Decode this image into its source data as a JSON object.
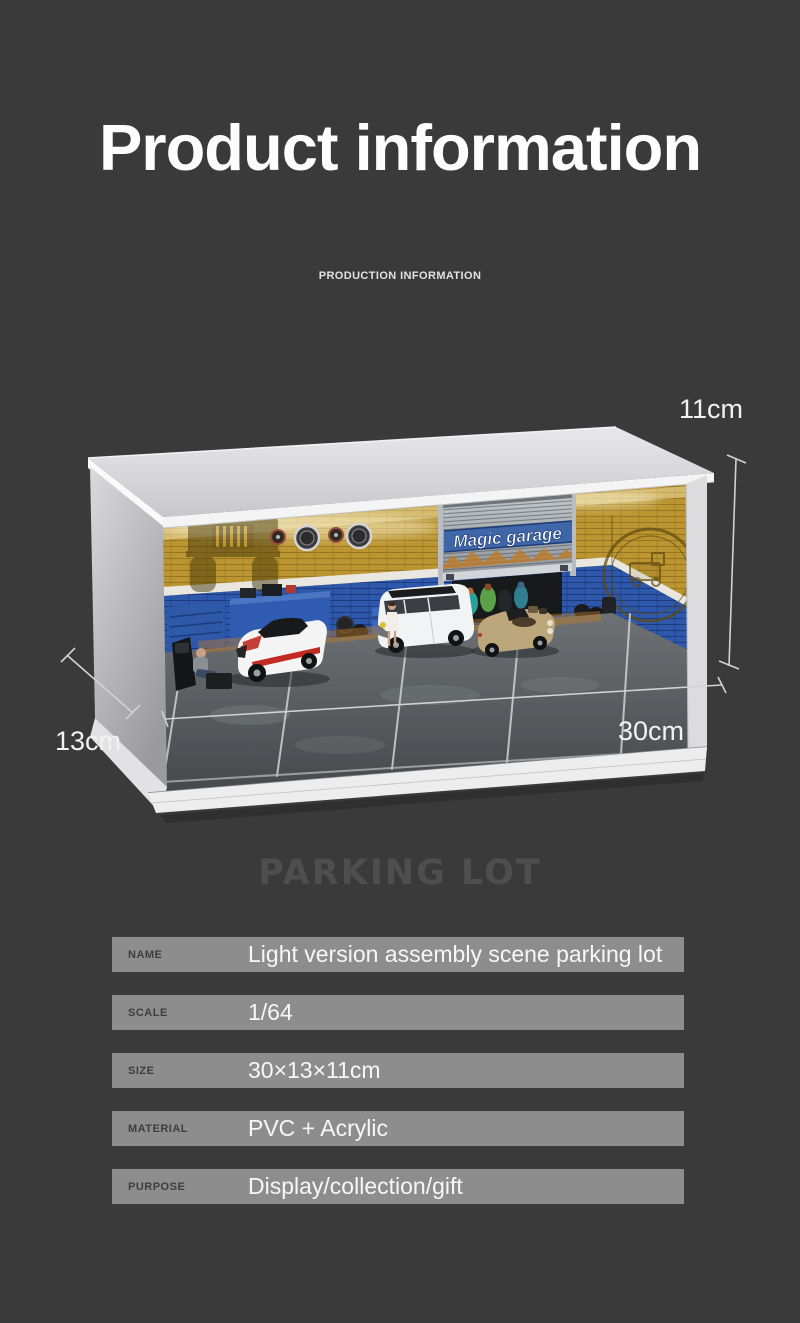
{
  "header": {
    "title": "Product information",
    "subtitle": "PRODUCTION INFORMATION"
  },
  "photo": {
    "dimension_labels": {
      "height": "11cm",
      "depth": "13cm",
      "width": "30cm"
    },
    "shutter_sign": "Magic garage",
    "wall_text": "KINCHES",
    "colors": {
      "wall_yellow": "#bb9530",
      "wall_blue": "#2d58ab",
      "shutter_band_blue": "#3f66a8",
      "accent_red": "#c22a22",
      "accent_orange": "#bf7a28",
      "car_gold": "#bca77c",
      "case_white": "#ededee",
      "background": "#3a3a3a",
      "spec_bar": "#8d8d8d"
    }
  },
  "section": {
    "heading": "PARKING LOT"
  },
  "specs": {
    "rows": [
      {
        "label": "NAME",
        "value": "Light version assembly scene parking lot"
      },
      {
        "label": "SCALE",
        "value": "1/64"
      },
      {
        "label": "SIZE",
        "value": "30×13×11cm"
      },
      {
        "label": "MATERIAL",
        "value": "PVC + Acrylic"
      },
      {
        "label": "PURPOSE",
        "value": "Display/collection/gift"
      }
    ]
  }
}
